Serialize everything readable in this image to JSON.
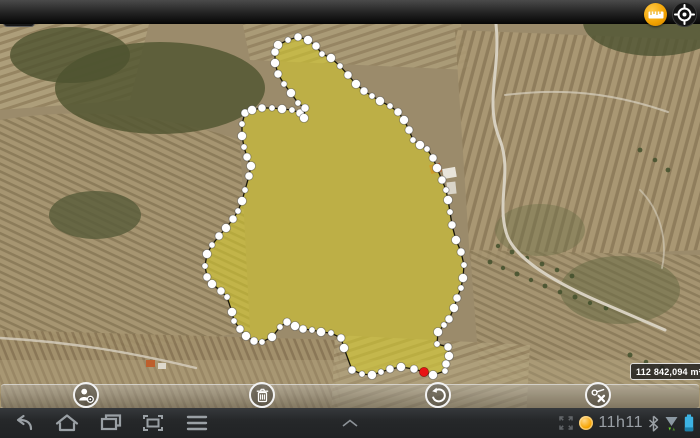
{
  "header": {
    "map_search_button_icon": "map-with-magnifier",
    "measure_button_icon": "ruler",
    "locate_button_icon": "gps-crosshair",
    "accent_color": "#f2a200"
  },
  "map": {
    "type": "satellite-imagery-with-measured-parcel",
    "area_label": "112 842,094 m²",
    "polygon": {
      "fill": "#d8ce28",
      "fill_opacity": 0.55,
      "stroke": "#17150a",
      "vertex_color": "#ffffff",
      "selected_color": "#e81414",
      "selected_index": 43,
      "points": [
        [
          278,
          45
        ],
        [
          288,
          40
        ],
        [
          298,
          37
        ],
        [
          308,
          40
        ],
        [
          316,
          46
        ],
        [
          322,
          54
        ],
        [
          331,
          58
        ],
        [
          340,
          66
        ],
        [
          348,
          75
        ],
        [
          356,
          84
        ],
        [
          364,
          91
        ],
        [
          372,
          96
        ],
        [
          380,
          101
        ],
        [
          390,
          106
        ],
        [
          398,
          112
        ],
        [
          404,
          120
        ],
        [
          409,
          130
        ],
        [
          413,
          140
        ],
        [
          420,
          145
        ],
        [
          427,
          149
        ],
        [
          433,
          158
        ],
        [
          437,
          168
        ],
        [
          442,
          180
        ],
        [
          446,
          190
        ],
        [
          448,
          200
        ],
        [
          450,
          212
        ],
        [
          452,
          225
        ],
        [
          456,
          240
        ],
        [
          461,
          252
        ],
        [
          464,
          265
        ],
        [
          463,
          278
        ],
        [
          461,
          288
        ],
        [
          457,
          298
        ],
        [
          454,
          308
        ],
        [
          449,
          319
        ],
        [
          444,
          325
        ],
        [
          438,
          332
        ],
        [
          437,
          344
        ],
        [
          448,
          347
        ],
        [
          449,
          356
        ],
        [
          446,
          364
        ],
        [
          445,
          371
        ],
        [
          433,
          375
        ],
        [
          424,
          372
        ],
        [
          414,
          369
        ],
        [
          401,
          367
        ],
        [
          390,
          369
        ],
        [
          381,
          372
        ],
        [
          372,
          375
        ],
        [
          362,
          374
        ],
        [
          352,
          370
        ],
        [
          344,
          348
        ],
        [
          341,
          338
        ],
        [
          331,
          333
        ],
        [
          321,
          332
        ],
        [
          312,
          330
        ],
        [
          303,
          329
        ],
        [
          295,
          326
        ],
        [
          287,
          322
        ],
        [
          280,
          327
        ],
        [
          272,
          337
        ],
        [
          262,
          342
        ],
        [
          254,
          341
        ],
        [
          246,
          336
        ],
        [
          240,
          329
        ],
        [
          234,
          321
        ],
        [
          232,
          312
        ],
        [
          227,
          297
        ],
        [
          221,
          291
        ],
        [
          212,
          284
        ],
        [
          207,
          277
        ],
        [
          205,
          266
        ],
        [
          207,
          254
        ],
        [
          212,
          245
        ],
        [
          219,
          236
        ],
        [
          226,
          228
        ],
        [
          233,
          219
        ],
        [
          238,
          211
        ],
        [
          242,
          201
        ],
        [
          245,
          190
        ],
        [
          249,
          176
        ],
        [
          251,
          166
        ],
        [
          247,
          157
        ],
        [
          244,
          147
        ],
        [
          242,
          136
        ],
        [
          242,
          124
        ],
        [
          245,
          113
        ],
        [
          252,
          110
        ],
        [
          262,
          108
        ],
        [
          272,
          108
        ],
        [
          282,
          109
        ],
        [
          292,
          110
        ],
        [
          300,
          113
        ],
        [
          304,
          118
        ],
        [
          305,
          108
        ],
        [
          298,
          103
        ],
        [
          291,
          93
        ],
        [
          284,
          84
        ],
        [
          278,
          74
        ],
        [
          275,
          63
        ],
        [
          275,
          52
        ]
      ]
    }
  },
  "toolstrip": {
    "buttons": [
      {
        "icon": "user-location"
      },
      {
        "icon": "trash"
      },
      {
        "icon": "undo"
      },
      {
        "icon": "delete-vertex"
      }
    ]
  },
  "system_bar": {
    "buttons": [
      "back",
      "home",
      "recent-apps",
      "screen-capture",
      "menu",
      "quick-panel-chevron",
      "fullscreen"
    ],
    "time": "11h11",
    "battery_color": "#3db3e3",
    "data_activity_color": "#6cd42c"
  }
}
